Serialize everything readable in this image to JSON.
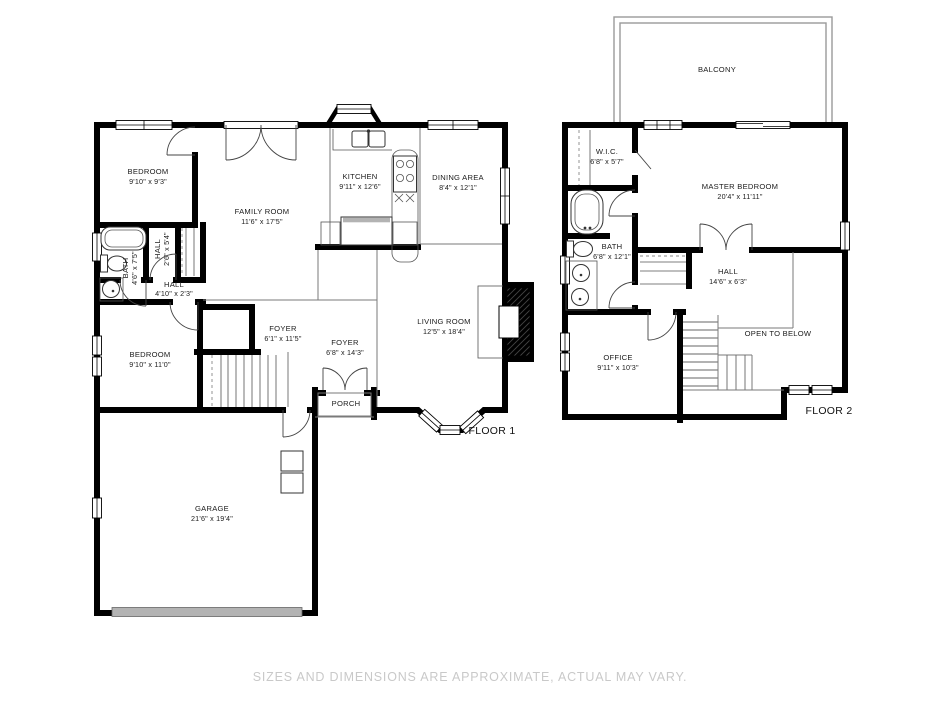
{
  "disclaimer": "SIZES AND DIMENSIONS ARE APPROXIMATE, ACTUAL MAY VARY.",
  "colors": {
    "wall": "#000000",
    "garage_door": "#b3b3b3",
    "disclaimer_text": "#c9c9c9"
  },
  "floor1": {
    "label": "FLOOR 1",
    "rooms": {
      "bedroom_top": {
        "name": "BEDROOM",
        "dims": "9'10\" x 9'3\""
      },
      "family_room": {
        "name": "FAMILY ROOM",
        "dims": "11'6\" x 17'5\""
      },
      "kitchen": {
        "name": "KITCHEN",
        "dims": "9'11\" x 12'6\""
      },
      "dining_area": {
        "name": "DINING AREA",
        "dims": "8'4\" x 12'1\""
      },
      "bath": {
        "name": "BATH",
        "dims": "4'6\" x 7'5\""
      },
      "hall_small": {
        "name": "HALL",
        "dims": "2'6\" x 5'4\""
      },
      "hall": {
        "name": "HALL",
        "dims": "4'10\" x 2'3\""
      },
      "bedroom_bottom": {
        "name": "BEDROOM",
        "dims": "9'10\" x 11'0\""
      },
      "foyer_left": {
        "name": "FOYER",
        "dims": "6'1\" x 11'5\""
      },
      "foyer_right": {
        "name": "FOYER",
        "dims": "6'8\" x 14'3\""
      },
      "living_room": {
        "name": "LIVING ROOM",
        "dims": "12'5\" x 18'4\""
      },
      "porch": {
        "name": "PORCH"
      },
      "garage": {
        "name": "GARAGE",
        "dims": "21'6\" x 19'4\""
      }
    }
  },
  "floor2": {
    "label": "FLOOR 2",
    "rooms": {
      "balcony": {
        "name": "BALCONY"
      },
      "wic": {
        "name": "W.I.C.",
        "dims": "6'8\" x 5'7\""
      },
      "master_bedroom": {
        "name": "MASTER BEDROOM",
        "dims": "20'4\" x 11'11\""
      },
      "bath": {
        "name": "BATH",
        "dims": "6'8\" x 12'1\""
      },
      "hall": {
        "name": "HALL",
        "dims": "14'6\" x 6'3\""
      },
      "office": {
        "name": "OFFICE",
        "dims": "9'11\" x 10'3\""
      },
      "open_to_below": {
        "name": "OPEN TO BELOW"
      }
    }
  }
}
